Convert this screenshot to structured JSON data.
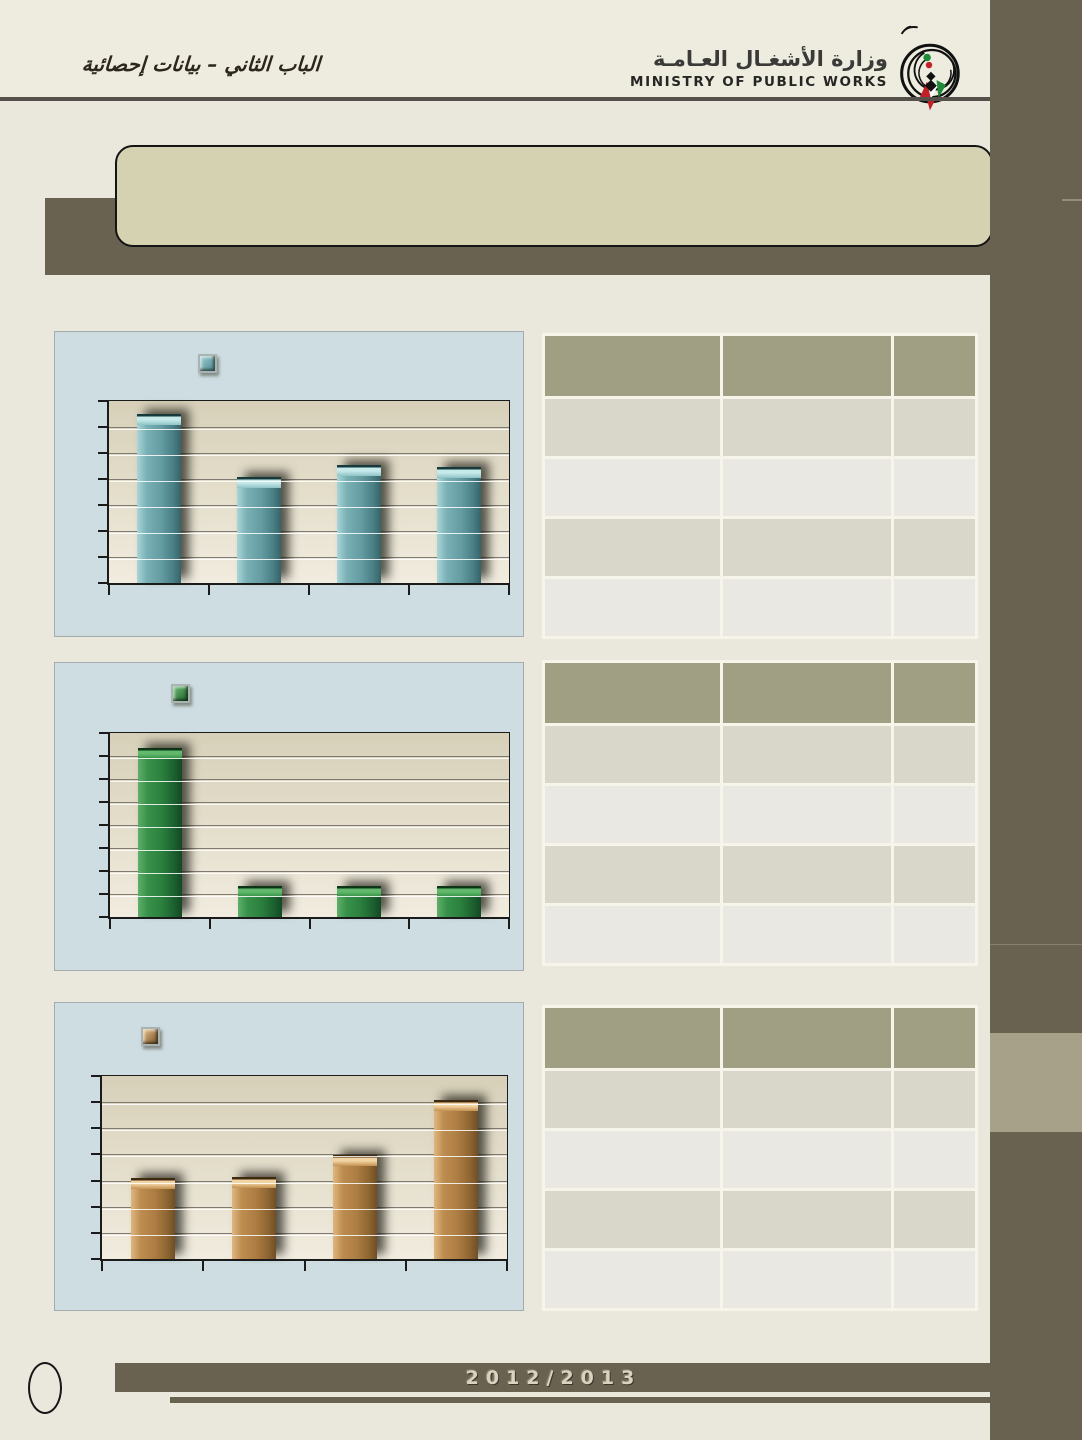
{
  "header": {
    "section_title_ar": "الباب الثاني – بيانات  إحصائية",
    "ministry_name_ar": "وزارة الأشغـال العـامـة",
    "ministry_name_en": "MINISTRY OF PUBLIC WORKS"
  },
  "banner": {
    "text": ""
  },
  "footer": {
    "academic_year": "2012/2013"
  },
  "colors": {
    "page_background": "#eae8dc",
    "dark_band": "#696250",
    "banner_fill": "#d5d2b2",
    "panel_fill": "#cddde1",
    "plot_fill": "#e5dfcd",
    "table_header": "#a19f83",
    "table_row_dark": "#d9d6ca",
    "table_row_light": "#e9e8e2",
    "strip_light_block": "#a7a189",
    "bar_teal": "#649ca2",
    "bar_green": "#2a7f3c",
    "bar_brown": "#ac7c42"
  },
  "chart_data": [
    {
      "type": "bar",
      "title": "",
      "xlabel": "",
      "ylabel": "",
      "categories": [
        "",
        "",
        "",
        ""
      ],
      "values_percent": [
        93,
        58,
        65,
        64
      ],
      "series_color": "#649ca2",
      "gridline_intervals": 7,
      "axis_labels_visible": false,
      "legend": {
        "swatch_only": true,
        "position": "top-left"
      }
    },
    {
      "type": "bar",
      "title": "",
      "xlabel": "",
      "ylabel": "",
      "categories": [
        "",
        "",
        "",
        ""
      ],
      "values_percent": [
        92,
        17,
        17,
        17
      ],
      "series_color": "#2a7f3c",
      "gridline_intervals": 8,
      "axis_labels_visible": false,
      "legend": {
        "swatch_only": true,
        "position": "top-left"
      }
    },
    {
      "type": "bar",
      "title": "",
      "xlabel": "",
      "ylabel": "",
      "categories": [
        "",
        "",
        "",
        ""
      ],
      "values_percent": [
        44,
        45,
        57,
        87
      ],
      "series_color": "#ac7c42",
      "gridline_intervals": 7,
      "axis_labels_visible": false,
      "legend": {
        "swatch_only": true,
        "position": "top-left"
      }
    }
  ],
  "tables": [
    {
      "columns": 3,
      "data_rows": 4,
      "header_text": [
        "",
        "",
        ""
      ]
    },
    {
      "columns": 3,
      "data_rows": 4,
      "header_text": [
        "",
        "",
        ""
      ]
    },
    {
      "columns": 3,
      "data_rows": 4,
      "header_text": [
        "",
        "",
        ""
      ]
    }
  ]
}
